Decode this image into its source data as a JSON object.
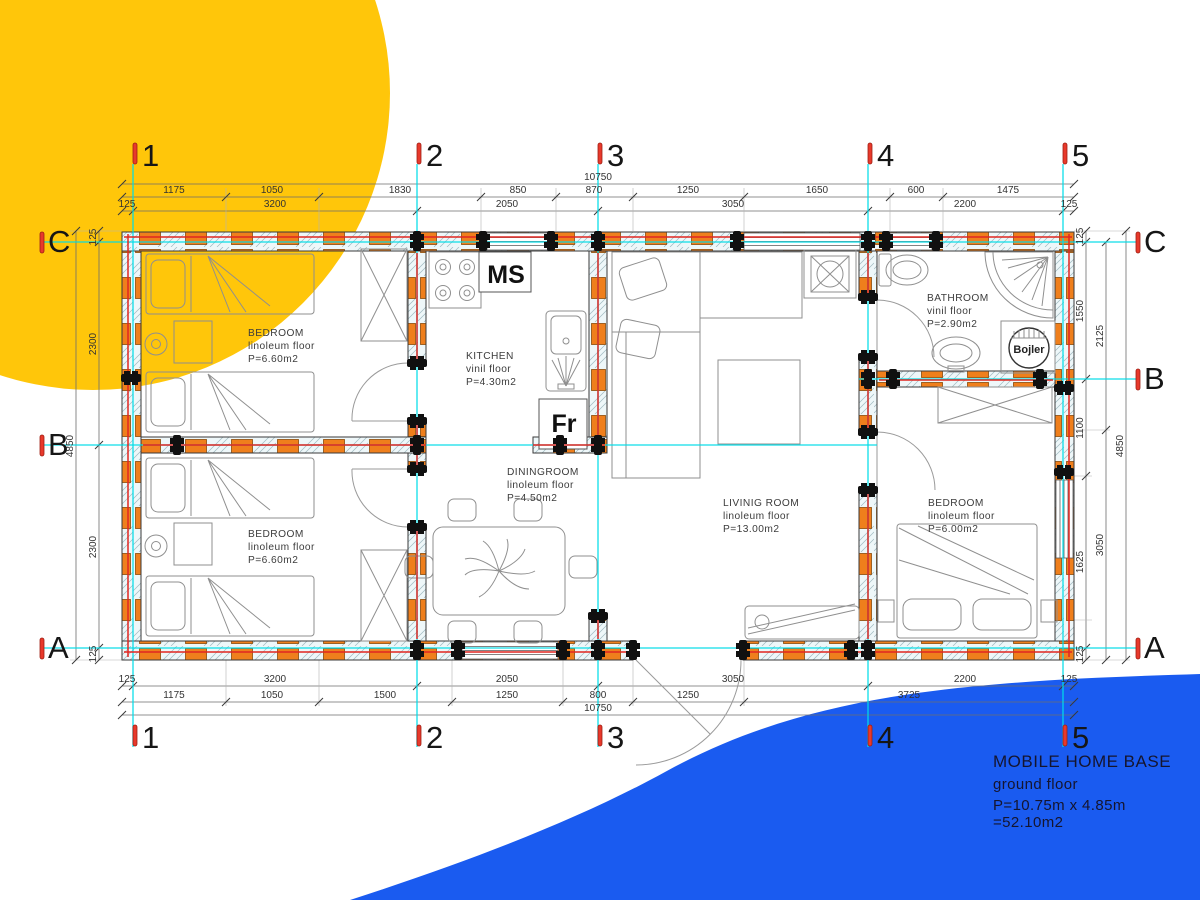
{
  "title_block": {
    "line1": "MOBILE HOME BASE",
    "line2": "ground floor",
    "line3": "P=10.75m x 4.85m =52.10m2"
  },
  "grid": {
    "cols": [
      "1",
      "2",
      "3",
      "4",
      "5"
    ],
    "rows": [
      "C",
      "B",
      "A"
    ]
  },
  "rooms": {
    "bedroom_tl": {
      "name": "BEDROOM",
      "floor": "linoleum floor",
      "area": "P=6.60m2"
    },
    "bedroom_bl": {
      "name": "BEDROOM",
      "floor": "linoleum floor",
      "area": "P=6.60m2"
    },
    "kitchen": {
      "name": "KITCHEN",
      "floor": "vinil floor",
      "area": "P=4.30m2"
    },
    "dining": {
      "name": "DININGROOM",
      "floor": "linoleum floor",
      "area": "P=4.50m2"
    },
    "living": {
      "name": "LIVINIG ROOM",
      "floor": "linoleum floor",
      "area": "P=13.00m2"
    },
    "bathroom": {
      "name": "BATHROOM",
      "floor": "vinil floor",
      "area": "P=2.90m2"
    },
    "bedroom_r": {
      "name": "BEDROOM",
      "floor": "linoleum floor",
      "area": "P=6.00m2"
    }
  },
  "appliances": {
    "ms": "MS",
    "fr": "Fr",
    "boiler": "Bojler"
  },
  "dims": {
    "top_total": "10750",
    "top_seg": [
      "1175",
      "1050",
      "1830",
      "850",
      "870",
      "1250",
      "1650",
      "600",
      "1475"
    ],
    "top_inner": [
      "125",
      "3200",
      "2050",
      "3050",
      "2200",
      "125"
    ],
    "bot_inner": [
      "125",
      "3200",
      "2050",
      "3050",
      "2200",
      "125"
    ],
    "bot_seg": [
      "1175",
      "1050",
      "1500",
      "1250",
      "800",
      "1250",
      "3725"
    ],
    "bot_total": "10750",
    "left_inner": [
      "125",
      "2300",
      "2300",
      "125"
    ],
    "left_total": "4850",
    "right_inner": [
      "125",
      "1550",
      "1100",
      "1625",
      "125"
    ],
    "right_mid": [
      "2125",
      "3050"
    ],
    "right_total": "4850"
  },
  "colors": {
    "yellow": "#FFC60A",
    "blue": "#1A5BF0",
    "wall_orange": "#EF7F1C",
    "line_red": "#E02621",
    "grid_cyan": "#00DCE8",
    "marker_red": "#E8392B"
  }
}
